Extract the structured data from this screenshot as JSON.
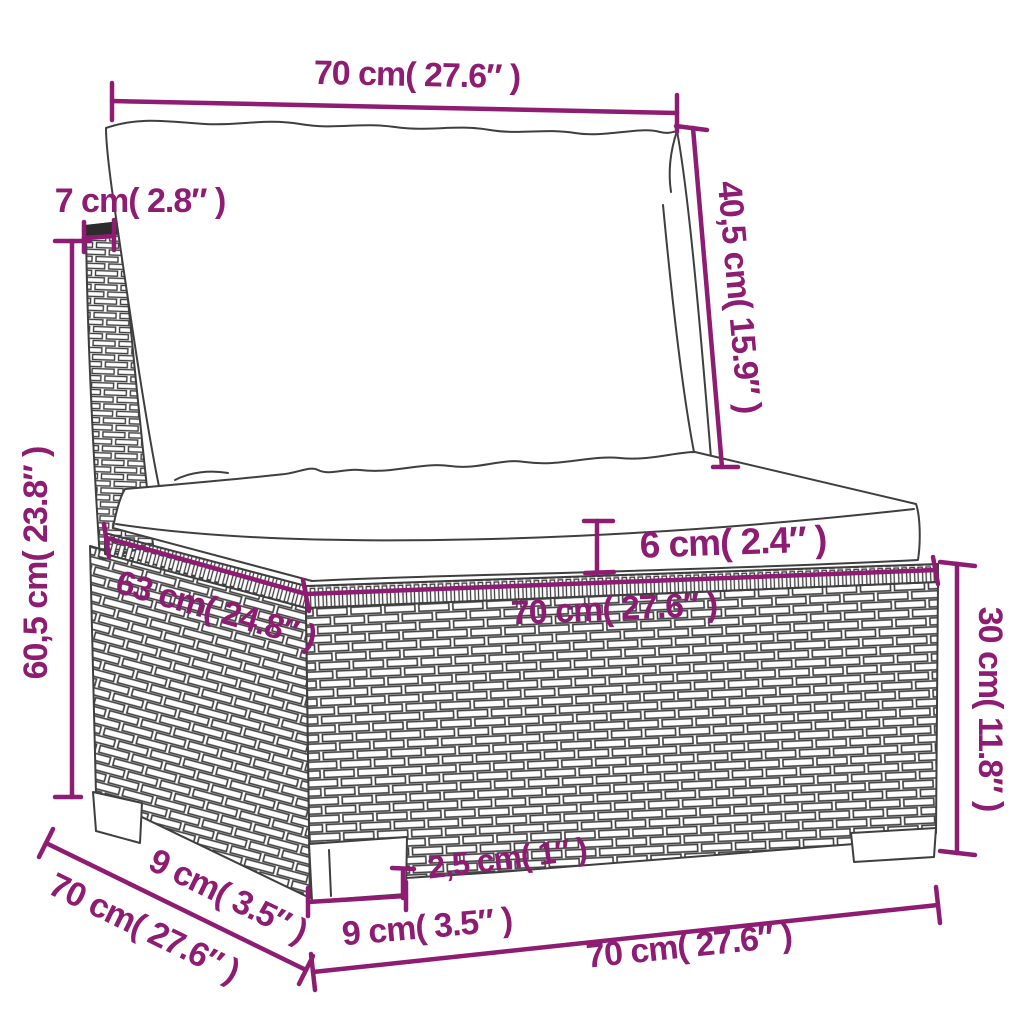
{
  "figure": {
    "type": "product-dimension-diagram",
    "subject": "rattan sectional sofa middle seat with cushions"
  },
  "colors": {
    "dimension_accent": "#8d1c72",
    "line_art": "#3f3f3f",
    "background": "#ffffff"
  },
  "dims": {
    "top_width": {
      "label": "70 cm( 27.6″ )"
    },
    "backrest_depth": {
      "label": "7 cm( 2.8″ )"
    },
    "backrest_height": {
      "label": "40,5 cm( 15.9″ )"
    },
    "total_height": {
      "label": "60,5 cm( 23.8″ )"
    },
    "cushion_thickness": {
      "label": "6 cm( 2.4″ )"
    },
    "seat_depth": {
      "label": "63 cm( 24.8″ )"
    },
    "seat_width": {
      "label": "70 cm( 27.6″ )"
    },
    "base_height": {
      "label": "30 cm( 11.8″ )"
    },
    "plinth_height": {
      "label": "2,5 cm( 1″ )"
    },
    "foot_width_front": {
      "label": "9 cm( 3.5″ )"
    },
    "foot_width_side": {
      "label": "9 cm( 3.5″ )"
    },
    "depth_total": {
      "label": "70 cm( 27.6″ )"
    },
    "bottom_width": {
      "label": "70 cm( 27.6″ )"
    }
  }
}
